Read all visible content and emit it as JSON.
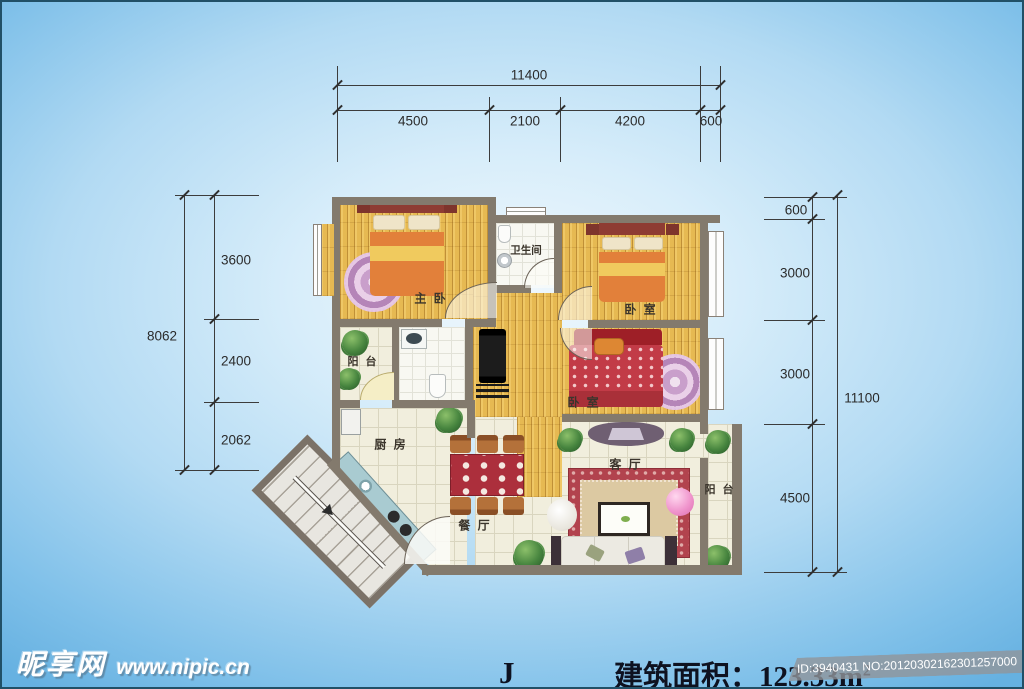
{
  "floor_plan": {
    "rooms": {
      "master_bedroom": "主 卧",
      "bathroom": "卫生间",
      "bedroom_top_right": "卧 室",
      "bedroom_mid_right": "卧 室",
      "balcony_left": "阳 台",
      "kitchen": "厨 房",
      "dining_room": "餐 厅",
      "living_room": "客 厅",
      "balcony_right": "阳 台"
    },
    "dimensions_top": {
      "total": "11400",
      "segments": [
        "4500",
        "2100",
        "4200",
        "600"
      ]
    },
    "dimensions_left": {
      "total": "8062",
      "segments": [
        "3600",
        "2400",
        "2062"
      ]
    },
    "dimensions_right": {
      "total": "11100",
      "segments": [
        "600",
        "3000",
        "3000",
        "4500"
      ]
    }
  },
  "footer": {
    "plan_type": "J",
    "area_text": "建筑面积：123.33m",
    "area_superscript": "2"
  },
  "watermarks": {
    "site_name": "昵享网",
    "site_url": "www.nipic.cn",
    "id_number": "ID:3940431 NO:20120302162301257000"
  },
  "colors": {
    "wall": "#837a6d",
    "wood_floor": "#e6b952",
    "tile_floor": "#f1eedd",
    "bed_orange": "#e2803a",
    "bed_red": "#c23b47",
    "background_blue": "#79bde8"
  }
}
